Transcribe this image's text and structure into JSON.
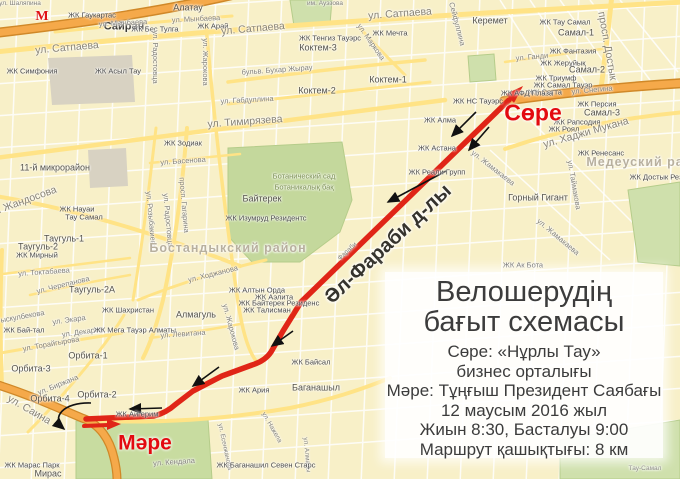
{
  "panel": {
    "title1": "Велошерудің",
    "title2": "бағыт схемасы",
    "lines": [
      "Сөре: «Нұрлы Тау»",
      "бизнес орталығы",
      "Мәре: Тұңғыш Президент Саябағы",
      "12 маусым 2016 жыл",
      "Жиын 8:30, Басталуы 9:00",
      "Маршрут қашықтығы: 8 км"
    ]
  },
  "route": {
    "start_label": "Сөре",
    "finish_label": "Мәре",
    "color": "#e02517",
    "main_d": "M509,100 L301,302 L283,331 L271,352 Q265,361 252,365 L222,376 L193,391 L176,404 Q166,413 154,416 L86,419",
    "return_d": "M84,426 L108,425",
    "start_arrow": "523,86 506,94 514,103",
    "finish_arrow": "121,424 107,419 107,430",
    "direction_arrows": [
      "M476,112 L452,136",
      "M489,127 L469,150",
      "M446,171 L388,202",
      "M293,331 L272,346",
      "M219,367 L193,386",
      "M162,408 L130,409"
    ],
    "loop_arrow": "M91,403 C64,402 50,417 64,429"
  },
  "colors": {
    "land": "#f8f0c8",
    "park": "#c8dca0",
    "gray_block": "#d8d2c2",
    "road_minor": "#ffffff",
    "road_yellow": "#ffe386",
    "road_orange": "#f5a94a",
    "road_orange_edge": "#d08828",
    "route_red": "#e02517"
  },
  "labels": [
    {
      "t": "ул. Шаляпина",
      "x": 20,
      "y": 4,
      "r": 0,
      "c": "street tiny"
    },
    {
      "t": "М",
      "x": 42,
      "y": 17,
      "r": 0,
      "c": "metro",
      "n": "metro-icon"
    },
    {
      "t": "Сайран",
      "x": 124,
      "y": 27,
      "r": 0,
      "c": "town-lg"
    },
    {
      "t": "ЖК Гаукартас",
      "x": 92,
      "y": 15,
      "r": 0,
      "c": "poi"
    },
    {
      "t": "Алатау",
      "x": 188,
      "y": 8,
      "r": 0,
      "c": "town"
    },
    {
      "t": "ул. Мынбаева",
      "x": 123,
      "y": 23,
      "r": -3,
      "c": "street"
    },
    {
      "t": "ул. Мынбаева",
      "x": 196,
      "y": 19,
      "r": -3,
      "c": "street"
    },
    {
      "t": "ЖК Арай",
      "x": 213,
      "y": 26,
      "r": 0,
      "c": "poi"
    },
    {
      "t": "ЖК Бес Тулга",
      "x": 155,
      "y": 29,
      "r": 0,
      "c": "poi"
    },
    {
      "t": "ул. Сатпаева",
      "x": 67,
      "y": 48,
      "r": -5,
      "c": "street-lg"
    },
    {
      "t": "ул. Сатпаева",
      "x": 253,
      "y": 29,
      "r": -5,
      "c": "street-lg"
    },
    {
      "t": "ул. Сатпаева",
      "x": 400,
      "y": 14,
      "r": -4,
      "c": "street-lg"
    },
    {
      "t": "им. Ауэзова",
      "x": 325,
      "y": 4,
      "r": 0,
      "c": "street tiny"
    },
    {
      "t": "ЖК Симфония",
      "x": 32,
      "y": 71,
      "r": 0,
      "c": "poi"
    },
    {
      "t": "ЖК Асыл Тау",
      "x": 118,
      "y": 71,
      "r": 0,
      "c": "poi"
    },
    {
      "t": "ул. Жарокова",
      "x": 205,
      "y": 62,
      "r": 90,
      "c": "street"
    },
    {
      "t": "ул. Радостовца",
      "x": 155,
      "y": 57,
      "r": 90,
      "c": "street"
    },
    {
      "t": "ЖК Тенгиз Тауэрс",
      "x": 330,
      "y": 38,
      "r": 0,
      "c": "poi"
    },
    {
      "t": "Коктем-3",
      "x": 318,
      "y": 48,
      "r": 0,
      "c": "town"
    },
    {
      "t": "ЖК Мечта",
      "x": 390,
      "y": 33,
      "r": 0,
      "c": "poi"
    },
    {
      "t": "ул. Маркова",
      "x": 371,
      "y": 42,
      "r": 55,
      "c": "street"
    },
    {
      "t": "Сейфуллина",
      "x": 457,
      "y": 24,
      "r": 75,
      "c": "street"
    },
    {
      "t": "бульв. Бухар Жырау",
      "x": 277,
      "y": 70,
      "r": -4,
      "c": "street"
    },
    {
      "t": "Коктем-2",
      "x": 317,
      "y": 91,
      "r": 0,
      "c": "town"
    },
    {
      "t": "Коктем-1",
      "x": 388,
      "y": 80,
      "r": 0,
      "c": "town"
    },
    {
      "t": "ул. Габдуллина",
      "x": 247,
      "y": 100,
      "r": -3,
      "c": "street"
    },
    {
      "t": "ул. Тимирязева",
      "x": 245,
      "y": 122,
      "r": -4,
      "c": "street-lg"
    },
    {
      "t": "Керемет",
      "x": 490,
      "y": 21,
      "r": 0,
      "c": "town"
    },
    {
      "t": "ЖК Тау Самал",
      "x": 565,
      "y": 22,
      "r": 0,
      "c": "poi"
    },
    {
      "t": "Самал-1",
      "x": 576,
      "y": 33,
      "r": 0,
      "c": "town"
    },
    {
      "t": "ЖК Фантазия",
      "x": 573,
      "y": 51,
      "r": 0,
      "c": "poi"
    },
    {
      "t": "ул. Ганди",
      "x": 532,
      "y": 57,
      "r": -5,
      "c": "street"
    },
    {
      "t": "ЖК Жерұйық",
      "x": 563,
      "y": 63,
      "r": 0,
      "c": "poi"
    },
    {
      "t": "Самал-2",
      "x": 587,
      "y": 70,
      "r": 0,
      "c": "town"
    },
    {
      "t": "ЖК Триумф",
      "x": 556,
      "y": 78,
      "r": 0,
      "c": "poi"
    },
    {
      "t": "ЖК Самал Тауэр",
      "x": 563,
      "y": 85,
      "r": 0,
      "c": "poi"
    },
    {
      "t": "ЖК Сатта",
      "x": 545,
      "y": 92,
      "r": 0,
      "c": "poi"
    },
    {
      "t": "ул. Снегина",
      "x": 592,
      "y": 90,
      "r": -5,
      "c": "street"
    },
    {
      "t": "ЖК АФД Плаза",
      "x": 527,
      "y": 93,
      "r": 0,
      "c": "poi"
    },
    {
      "t": "просп. Достык",
      "x": 607,
      "y": 46,
      "r": 80,
      "c": "street-lg"
    },
    {
      "t": "ЖК НС Тауэрс",
      "x": 478,
      "y": 101,
      "r": 0,
      "c": "poi"
    },
    {
      "t": "ЖК Персия",
      "x": 597,
      "y": 104,
      "r": 0,
      "c": "poi"
    },
    {
      "t": "Самал-3",
      "x": 602,
      "y": 113,
      "r": 0,
      "c": "town"
    },
    {
      "t": "ЖК Рапсодия",
      "x": 577,
      "y": 122,
      "r": 0,
      "c": "poi"
    },
    {
      "t": "ЖК Роял",
      "x": 564,
      "y": 129,
      "r": 0,
      "c": "poi"
    },
    {
      "t": "ул. Хаджи Мукана",
      "x": 586,
      "y": 133,
      "r": -16,
      "c": "street-lg"
    },
    {
      "t": "ЖК Ренесанс",
      "x": 601,
      "y": 153,
      "r": 0,
      "c": "poi"
    },
    {
      "t": "Медеуский район",
      "x": 648,
      "y": 162,
      "r": 0,
      "c": "district"
    },
    {
      "t": "ЖК Достык Рез",
      "x": 656,
      "y": 177,
      "r": 0,
      "c": "poi"
    },
    {
      "t": "ЖК Алма",
      "x": 440,
      "y": 120,
      "r": 0,
      "c": "poi"
    },
    {
      "t": "ЖК Астана",
      "x": 437,
      "y": 148,
      "r": 0,
      "c": "poi"
    },
    {
      "t": "ЖК Реали Групп",
      "x": 437,
      "y": 172,
      "r": 0,
      "c": "poi"
    },
    {
      "t": "ул. Жамакаева",
      "x": 493,
      "y": 168,
      "r": 38,
      "c": "street"
    },
    {
      "t": "ул. Жамакаева",
      "x": 558,
      "y": 237,
      "r": 40,
      "c": "street"
    },
    {
      "t": "ул. Таймакова",
      "x": 574,
      "y": 185,
      "r": 80,
      "c": "street"
    },
    {
      "t": "Горный Гигант",
      "x": 538,
      "y": 198,
      "r": 0,
      "c": "town"
    },
    {
      "t": "ЖК Ак Бота",
      "x": 523,
      "y": 265,
      "r": 0,
      "c": "poi"
    },
    {
      "t": "ЖК Зодиак",
      "x": 183,
      "y": 143,
      "r": 0,
      "c": "poi"
    },
    {
      "t": "ул. Басенова",
      "x": 183,
      "y": 161,
      "r": -4,
      "c": "street"
    },
    {
      "t": "просп. Гагарина",
      "x": 184,
      "y": 205,
      "r": 85,
      "c": "street"
    },
    {
      "t": "ул. Радостовца",
      "x": 168,
      "y": 220,
      "r": 85,
      "c": "street"
    },
    {
      "t": "ул. Розыбакиева",
      "x": 151,
      "y": 220,
      "r": 85,
      "c": "street"
    },
    {
      "t": "11-й микрорайон",
      "x": 55,
      "y": 168,
      "r": 0,
      "c": "town"
    },
    {
      "t": "ул. Жандосова",
      "x": 22,
      "y": 202,
      "r": -20,
      "c": "street-lg"
    },
    {
      "t": "ЖК Науаи",
      "x": 77,
      "y": 209,
      "r": 0,
      "c": "poi"
    },
    {
      "t": "Тау Самал",
      "x": 84,
      "y": 217,
      "r": 0,
      "c": "poi"
    },
    {
      "t": "Байтерек",
      "x": 262,
      "y": 199,
      "r": 0,
      "c": "town"
    },
    {
      "t": "ЖК Изумруд Резидентс",
      "x": 266,
      "y": 218,
      "r": 0,
      "c": "poi"
    },
    {
      "t": "Ботанический сад",
      "x": 304,
      "y": 176,
      "r": 0,
      "c": "area-label"
    },
    {
      "t": "Ботаникалық бақ",
      "x": 304,
      "y": 187,
      "r": 0,
      "c": "area-label"
    },
    {
      "t": "Бостандыкский район",
      "x": 228,
      "y": 248,
      "r": 0,
      "c": "district"
    },
    {
      "t": "ул. Ходжанова",
      "x": 213,
      "y": 274,
      "r": -14,
      "c": "street"
    },
    {
      "t": "Таугуль-1",
      "x": 64,
      "y": 239,
      "r": 0,
      "c": "town"
    },
    {
      "t": "Таугуль-2",
      "x": 38,
      "y": 247,
      "r": 0,
      "c": "town"
    },
    {
      "t": "ЖК Мирный",
      "x": 37,
      "y": 255,
      "r": 0,
      "c": "poi"
    },
    {
      "t": "ул. Токтабаева",
      "x": 44,
      "y": 272,
      "r": -4,
      "c": "street"
    },
    {
      "t": "ул. Черепанова",
      "x": 63,
      "y": 285,
      "r": -14,
      "c": "street"
    },
    {
      "t": "Таугуль-2А",
      "x": 92,
      "y": 290,
      "r": 0,
      "c": "town"
    },
    {
      "t": "Рыскулбекова",
      "x": 20,
      "y": 317,
      "r": -10,
      "c": "street"
    },
    {
      "t": "ЖК Бай-тал",
      "x": 24,
      "y": 330,
      "r": 0,
      "c": "poi"
    },
    {
      "t": "ул. Экара",
      "x": 69,
      "y": 320,
      "r": -8,
      "c": "street"
    },
    {
      "t": "ул. Декарта",
      "x": 82,
      "y": 332,
      "r": -8,
      "c": "street"
    },
    {
      "t": "ул. Торайгырова",
      "x": 51,
      "y": 344,
      "r": -10,
      "c": "street"
    },
    {
      "t": "ЖК Шахристан",
      "x": 128,
      "y": 310,
      "r": 0,
      "c": "poi"
    },
    {
      "t": "ЖК Мега Тауэр Алматы",
      "x": 135,
      "y": 330,
      "r": 0,
      "c": "poi"
    },
    {
      "t": "Алмагуль",
      "x": 196,
      "y": 315,
      "r": 0,
      "c": "town"
    },
    {
      "t": "ул. Левитана",
      "x": 183,
      "y": 334,
      "r": -4,
      "c": "street"
    },
    {
      "t": "ул. Жарокова",
      "x": 231,
      "y": 327,
      "r": 75,
      "c": "street"
    },
    {
      "t": "ЖК Алтын Орда",
      "x": 257,
      "y": 290,
      "r": 0,
      "c": "poi"
    },
    {
      "t": "ЖК Аэлита",
      "x": 274,
      "y": 297,
      "r": 0,
      "c": "poi"
    },
    {
      "t": "ЖК Байтерек Резиденс",
      "x": 279,
      "y": 303,
      "r": 0,
      "c": "poi"
    },
    {
      "t": "ЖК Талисман",
      "x": 267,
      "y": 310,
      "r": 0,
      "c": "poi"
    },
    {
      "t": "Әл-Фараби д-лы",
      "x": 388,
      "y": 244,
      "r": -43,
      "c": "route-big"
    },
    {
      "t": "Фараби",
      "x": 348,
      "y": 252,
      "r": -43,
      "c": "street tiny"
    },
    {
      "t": "ЖК Байсал",
      "x": 311,
      "y": 362,
      "r": 0,
      "c": "poi"
    },
    {
      "t": "Баганашыл",
      "x": 316,
      "y": 388,
      "r": 0,
      "c": "town"
    },
    {
      "t": "ЖК Ария",
      "x": 254,
      "y": 390,
      "r": 0,
      "c": "poi"
    },
    {
      "t": "Орбита-1",
      "x": 88,
      "y": 356,
      "r": 0,
      "c": "town"
    },
    {
      "t": "Орбита-2",
      "x": 97,
      "y": 395,
      "r": 0,
      "c": "town"
    },
    {
      "t": "Орбита-3",
      "x": 31,
      "y": 369,
      "r": 0,
      "c": "town"
    },
    {
      "t": "Орбита-4",
      "x": 50,
      "y": 399,
      "r": 0,
      "c": "town"
    },
    {
      "t": "ул. Биржана",
      "x": 58,
      "y": 385,
      "r": -22,
      "c": "street"
    },
    {
      "t": "ул. Саина",
      "x": 29,
      "y": 410,
      "r": 30,
      "c": "street-lg"
    },
    {
      "t": "ЖК Айгерим",
      "x": 137,
      "y": 414,
      "r": 0,
      "c": "poi"
    },
    {
      "t": "Сөре",
      "x": 533,
      "y": 113,
      "r": 0,
      "c": "red-big",
      "n": "route-start-label"
    },
    {
      "t": "Мәре",
      "x": 145,
      "y": 443,
      "r": 0,
      "c": "red-big2",
      "n": "route-finish-label"
    },
    {
      "t": "ЖК Марас Парк",
      "x": 32,
      "y": 465,
      "r": 0,
      "c": "poi"
    },
    {
      "t": "Мирас",
      "x": 48,
      "y": 474,
      "r": 0,
      "c": "town"
    },
    {
      "t": "ул. Кендала",
      "x": 174,
      "y": 462,
      "r": -4,
      "c": "street"
    },
    {
      "t": "ул. Есенжанова",
      "x": 224,
      "y": 447,
      "r": 78,
      "c": "street tiny"
    },
    {
      "t": "ул. Нажела",
      "x": 271,
      "y": 428,
      "r": 60,
      "c": "street tiny"
    },
    {
      "t": "ул. Алмалы",
      "x": 306,
      "y": 455,
      "r": 85,
      "c": "street tiny"
    },
    {
      "t": "ЖК Баганашил Севен Старс",
      "x": 266,
      "y": 465,
      "r": 0,
      "c": "poi"
    },
    {
      "t": "Тау-Самал",
      "x": 645,
      "y": 469,
      "r": 0,
      "c": "street tiny"
    }
  ]
}
